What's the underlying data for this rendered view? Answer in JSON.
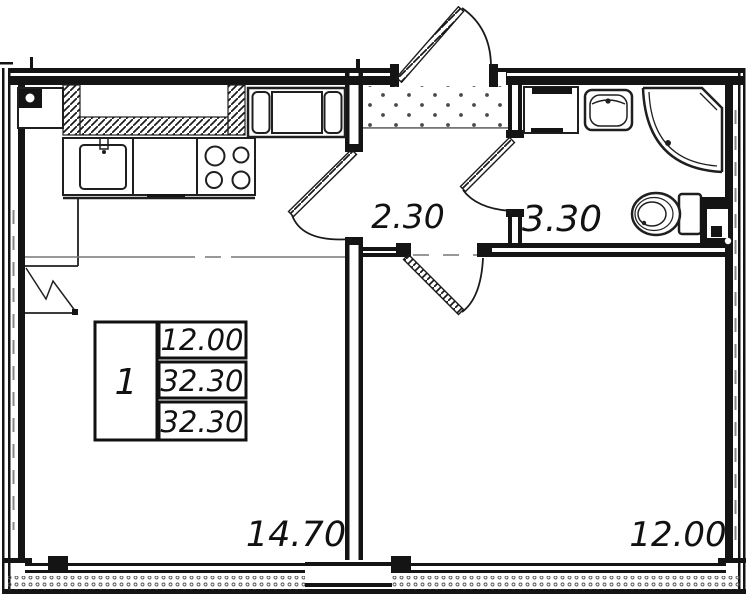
{
  "plan": {
    "rooms": {
      "hallway": {
        "name": "hallway",
        "area_label": "2.30"
      },
      "bathroom": {
        "name": "bathroom",
        "area_label": "3.30"
      },
      "kitchen_living": {
        "name": "kitchen-living",
        "area_label": "14.70"
      },
      "bedroom": {
        "name": "bedroom",
        "area_label": "12.00"
      }
    },
    "info_table": {
      "rooms_count": "1",
      "values": [
        "12.00",
        "32.30",
        "32.30"
      ]
    },
    "colors": {
      "line": "#141414",
      "background": "#ffffff",
      "hatch": "#222222",
      "stipple": "#555555"
    }
  }
}
